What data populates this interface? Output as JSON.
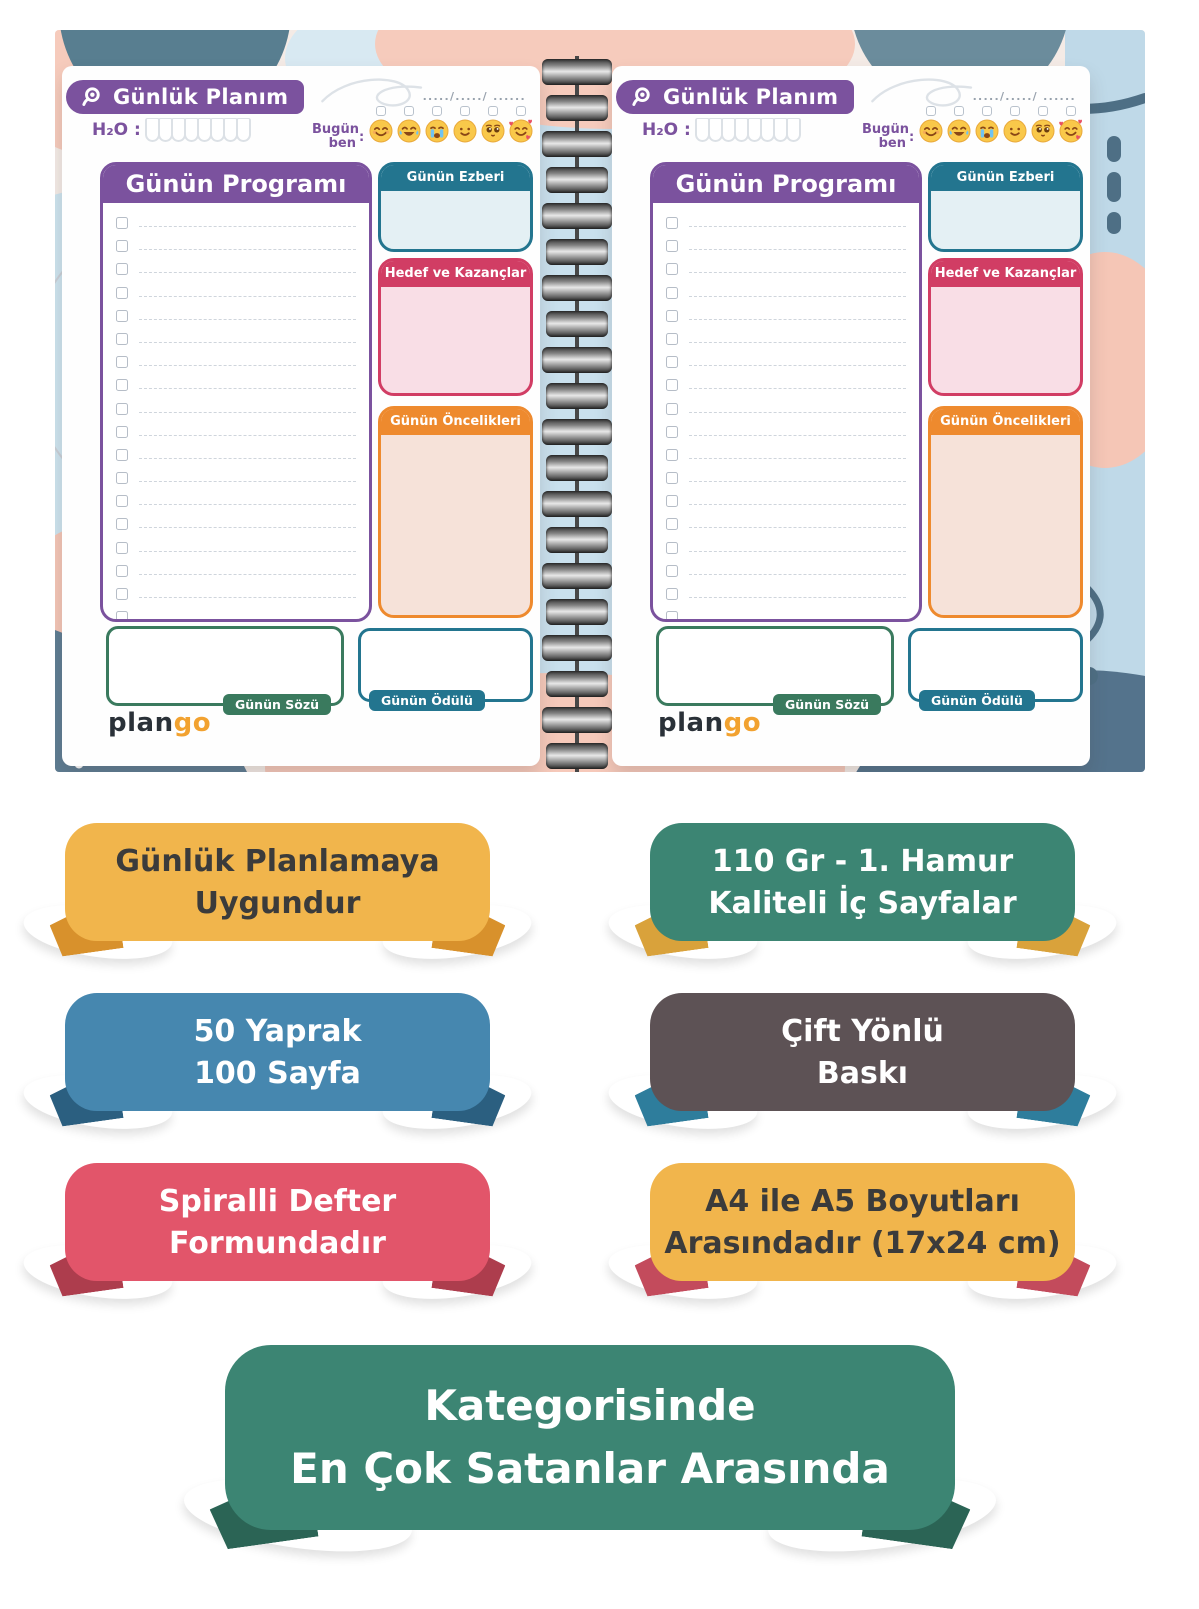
{
  "palette": {
    "purple": "#7B529E",
    "teal": "#23758F",
    "teal_body": "#E4F0F4",
    "crimson": "#D13D64",
    "pink_body": "#F9DEE6",
    "orange": "#EE8A2E",
    "peach_body": "#F6E2D9",
    "green": "#3A7A5E",
    "logo_navy": "#2A3138",
    "logo_orange": "#F2A230"
  },
  "page": {
    "title": "Günlük Planım",
    "date_placeholder": "...../...../ ......",
    "h2o_label": "H₂O :",
    "water_cups": 8,
    "mood_label_line1": "Bugün",
    "mood_label_line2": "ben",
    "mood_colon": ":",
    "moods": [
      "smiling-face",
      "face-with-tears-of-joy",
      "loudly-crying-face",
      "slightly-smiling-face",
      "pleading-face",
      "smiling-face-with-hearts"
    ],
    "sections": {
      "program": "Günün Programı",
      "memorization": "Günün Ezberi",
      "goals": "Hedef ve Kazançlar",
      "priorities": "Günün Öncelikleri",
      "quote": "Günün Sözü",
      "reward": "Günün Ödülü"
    },
    "logo": {
      "plan": "plan",
      "go": "go"
    }
  },
  "badges": [
    {
      "lines": [
        "Günlük Planlamaya",
        "Uygundur"
      ],
      "bg": "#F1B54C",
      "fg": "#3B3B3B",
      "flap": "#D8912C"
    },
    {
      "lines": [
        "110 Gr - 1. Hamur",
        "Kaliteli İç Sayfalar"
      ],
      "bg": "#3C8573",
      "fg": "#FFFFFF",
      "flap": "#D9A23B"
    },
    {
      "lines": [
        "50 Yaprak",
        "100 Sayfa"
      ],
      "bg": "#4687AF",
      "fg": "#FFFFFF",
      "flap": "#2B5F80"
    },
    {
      "lines": [
        "Çift Yönlü",
        "Baskı"
      ],
      "bg": "#5D5255",
      "fg": "#FFFFFF",
      "flap": "#2E7D9C"
    },
    {
      "lines": [
        "Spiralli Defter",
        "Formundadır"
      ],
      "bg": "#E2556A",
      "fg": "#FFFFFF",
      "flap": "#AD3D4D"
    },
    {
      "lines": [
        "A4 ile A5 Boyutları",
        "Arasındadır (17x24 cm)"
      ],
      "bg": "#F1B54C",
      "fg": "#3B3B3B",
      "flap": "#C34B5C"
    },
    {
      "lines": [
        "Kategorisinde",
        "En Çok Satanlar Arasında"
      ],
      "bg": "#3C8573",
      "fg": "#FFFFFF",
      "flap": "#2B6455"
    }
  ]
}
